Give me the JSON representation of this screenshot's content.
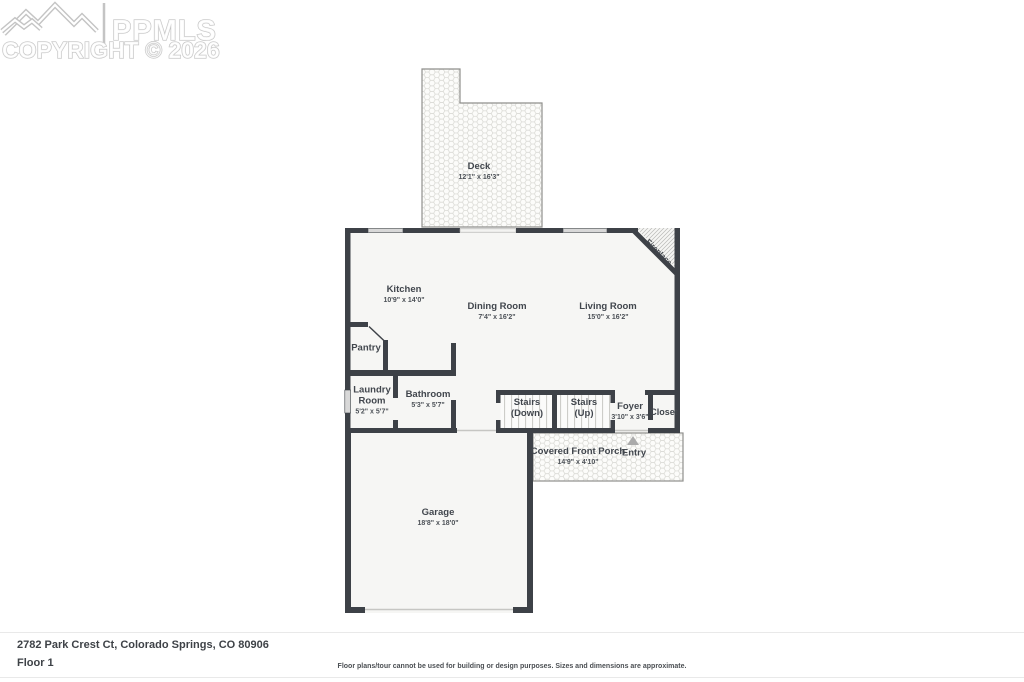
{
  "watermark": {
    "brand": "PPMLS",
    "copyright": "COPYRIGHT © 2026"
  },
  "plan": {
    "deck": {
      "name": "Deck",
      "dims": "12'1\" x 16'3\""
    },
    "kitchen": {
      "name": "Kitchen",
      "dims": "10'9\" x 14'0\""
    },
    "dining_room": {
      "name": "Dining Room",
      "dims": "7'4\" x 16'2\""
    },
    "living_room": {
      "name": "Living Room",
      "dims": "15'0\" x 16'2\""
    },
    "fireplace": {
      "name": "Fireplace"
    },
    "pantry": {
      "name": "Pantry"
    },
    "laundry_room": {
      "name": "Laundry Room",
      "dims": "5'2\" x 5'7\""
    },
    "bathroom": {
      "name": "Bathroom",
      "dims": "5'3\" x 5'7\""
    },
    "stairs_down": {
      "name": "Stairs",
      "sub": "(Down)"
    },
    "stairs_up": {
      "name": "Stairs",
      "sub": "(Up)"
    },
    "foyer": {
      "name": "Foyer",
      "dims": "3'10\" x 3'6\""
    },
    "closet": {
      "name": "Closet"
    },
    "porch": {
      "name": "Covered Front Porch",
      "dims": "14'9\" x 4'10\""
    },
    "entry": {
      "name": "Entry"
    },
    "garage": {
      "name": "Garage",
      "dims": "18'8\" x 18'0\""
    }
  },
  "footer": {
    "address": "2782 Park Crest Ct, Colorado Springs, CO 80906",
    "floor_label": "Floor 1",
    "disclaimer": "Floor plans/tour cannot be used for building or design purposes. Sizes and dimensions are approximate."
  },
  "colors": {
    "wall": "#3d4147",
    "floor": "#f6f6f4",
    "window": "#d8d8d8",
    "label": "#41464d",
    "watermark": "#c4c4c4",
    "pattern-line": "#d9d9d4"
  }
}
